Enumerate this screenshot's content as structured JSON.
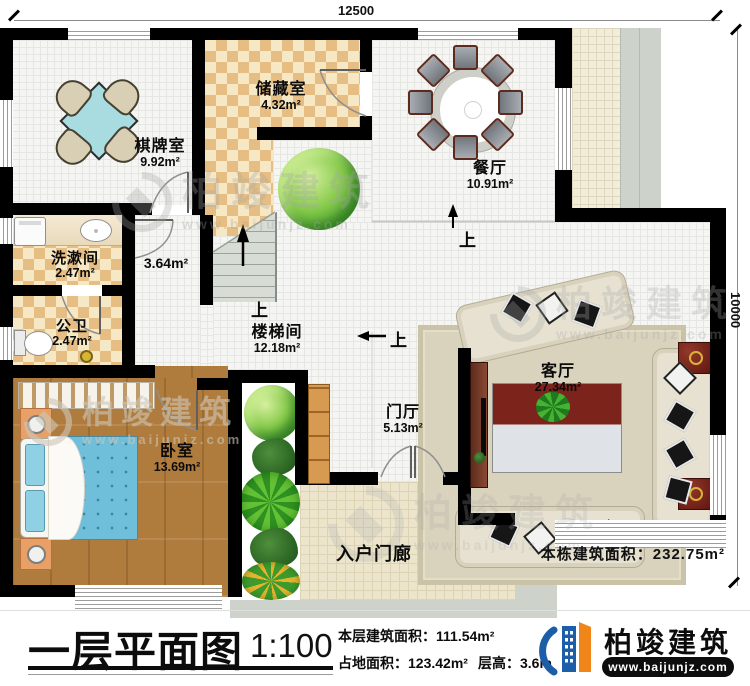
{
  "dimensions": {
    "top": "12500",
    "right": "10000"
  },
  "rooms": {
    "chess": {
      "name": "棋牌室",
      "area": "9.92m²"
    },
    "storage": {
      "name": "储藏室",
      "area": "4.32m²"
    },
    "dining": {
      "name": "餐厅",
      "area": "10.91m²"
    },
    "wash": {
      "name": "洗漱间",
      "area": "2.47m²"
    },
    "toilet": {
      "name": "公卫",
      "area": "2.47m²"
    },
    "stair_hall": {
      "name": "楼梯间",
      "area": "12.18m²"
    },
    "foyer": {
      "name": "门厅",
      "area": "5.13m²"
    },
    "living": {
      "name": "客厅",
      "area": "27.34m²"
    },
    "bedroom": {
      "name": "卧室",
      "area": "13.69m²"
    },
    "porch": {
      "name": "入户门廊"
    },
    "hall_area": "3.64m²"
  },
  "annotations": {
    "up": "上",
    "building_total": "本栋建筑面积：232.75m²"
  },
  "watermark": {
    "brand": "柏竣建筑",
    "url": "www.baijunjz.com"
  },
  "title_block": {
    "title": "一层平面图",
    "scale": "1:100",
    "floor_area": "本层建筑面积：111.54m²",
    "footprint": "占地面积：123.42m²",
    "story_height": "层高：3.6m",
    "brand": "柏竣建筑",
    "url": "www.baijunjz.com"
  },
  "colors": {
    "wall": "#000000",
    "accent_blue": "#1c5fa8",
    "accent_orange": "#f08519",
    "wood_floor": "#b07c3e",
    "checker_floor": "#e6bd82",
    "bed": "#6fbeda",
    "game_table": "#a9dce0",
    "sofa": "#e6e1d0",
    "end_table": "#6e1f16"
  }
}
